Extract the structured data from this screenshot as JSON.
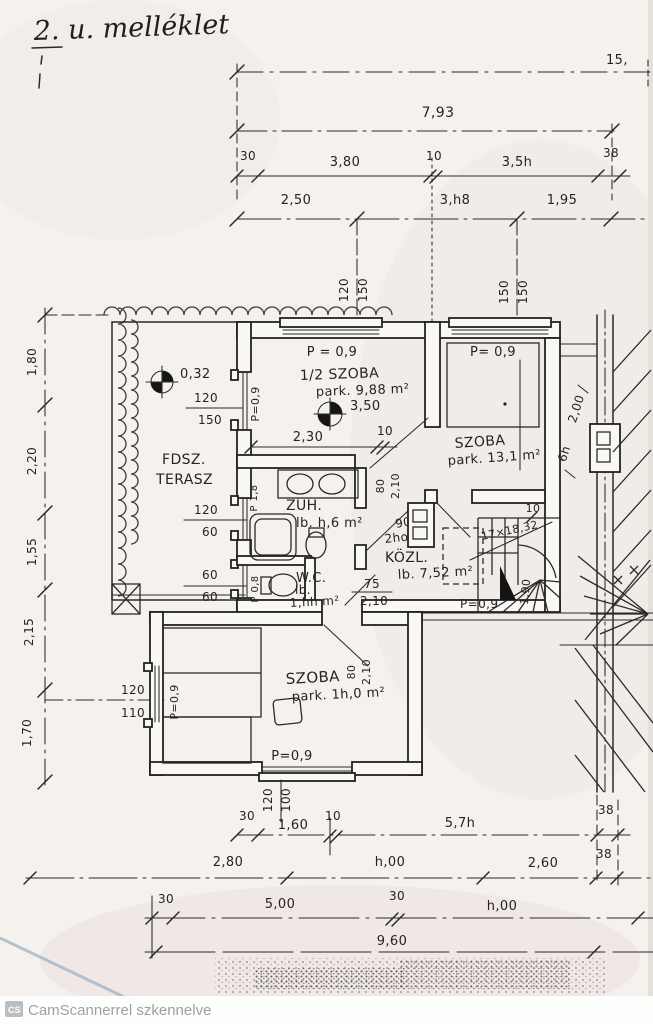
{
  "title": "2. u. melléklet",
  "watermark": {
    "logo": "CS",
    "text": "CamScannerrel szkennelve"
  },
  "top_dims": {
    "overall_right": "15,",
    "total": "7,93",
    "row1": [
      "30",
      "3,80",
      "10",
      "3,5h",
      "38"
    ],
    "row2": [
      "2,50",
      "3,h8",
      "1,95"
    ],
    "win1": [
      "120",
      "150"
    ],
    "win2": [
      "150",
      "150"
    ]
  },
  "left_dims": {
    "col": [
      "1,80",
      "2,20",
      "1,55",
      "2,15",
      "1,70"
    ],
    "win": [
      "120",
      "110"
    ]
  },
  "bottom_dims": {
    "win": [
      "120",
      "100"
    ],
    "row1": [
      "30",
      "1,60",
      "10",
      "5,7h",
      "38"
    ],
    "row2": [
      "2,80",
      "h,00",
      "2,60",
      "38"
    ],
    "row3": [
      "30",
      "5,00",
      "30",
      "h,00"
    ],
    "total": "9,60"
  },
  "rooms": {
    "terasz": {
      "name1": "FDSZ.",
      "name2": "TERASZ",
      "level": "0,32",
      "win": [
        "120",
        "150"
      ],
      "w1": [
        "120",
        "60"
      ],
      "w2": [
        "60",
        "60"
      ]
    },
    "half_szoba": {
      "name": "1/2 SZOBA",
      "area": "park. 9,88 m²",
      "level": "3,50",
      "parapet": "P = 0,9",
      "parapet_side": "P=0,9",
      "dim": [
        "2,30",
        "10"
      ]
    },
    "szoba_top": {
      "name": "SZOBA",
      "area": "park. 13,1 m²",
      "parapet": "P= 0,9",
      "side": [
        "2,00",
        "6h"
      ]
    },
    "zuh": {
      "name": "ZUH.",
      "area": "lb. h,6 m²",
      "tub": "P 1,8"
    },
    "wc": {
      "name": "W.C.",
      "lb": "lb.",
      "area": "1,hh m²",
      "side": "P 0,8"
    },
    "kozl": {
      "name": "KÖZL.",
      "area": "lb. 7,52 m²",
      "door1": [
        "80",
        "2,10"
      ],
      "door2": [
        "90",
        "2ho"
      ],
      "door3": [
        "75",
        "2,10"
      ]
    },
    "szoba_bottom": {
      "name": "SZOBA",
      "area": "park. 1h,0 m²",
      "side": "P=0,9",
      "parapet": "P=0,9",
      "door": [
        "80",
        "2,10"
      ]
    },
    "stair": {
      "label": "17×18,32",
      "run": "1,90",
      "ten": "10",
      "parapet": "P=0,9"
    }
  }
}
